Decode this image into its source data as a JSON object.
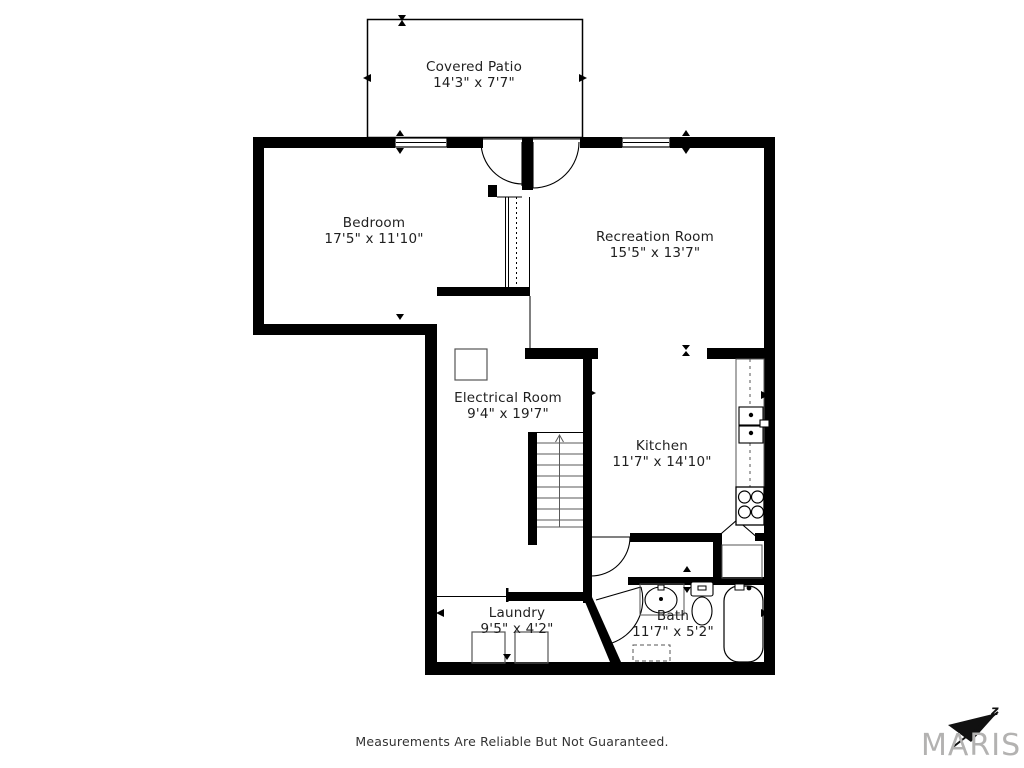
{
  "rooms": [
    {
      "id": "covered-patio",
      "name": "Covered Patio",
      "dims": "14'3\" x 7'7\""
    },
    {
      "id": "bedroom",
      "name": "Bedroom",
      "dims": "17'5\" x 11'10\""
    },
    {
      "id": "recreation-room",
      "name": "Recreation Room",
      "dims": "15'5\" x 13'7\""
    },
    {
      "id": "electrical-room",
      "name": "Electrical Room",
      "dims": "9'4\" x 19'7\""
    },
    {
      "id": "kitchen",
      "name": "Kitchen",
      "dims": "11'7\" x 14'10\""
    },
    {
      "id": "laundry",
      "name": "Laundry",
      "dims": "9'5\" x 4'2\""
    },
    {
      "id": "bath",
      "name": "Bath",
      "dims": "11'7\" x 5'2\""
    }
  ],
  "footer": {
    "disclaimer": "Measurements Are Reliable But Not Guaranteed."
  },
  "logo": {
    "text": "MARIS",
    "mark": "z"
  },
  "colors": {
    "wall": "#000000",
    "line": "#3d3d3d",
    "label": "#1f1f1f",
    "logo_gray": "#b3b2b1"
  },
  "fixtures": [
    "staircase",
    "electrical-panel",
    "kitchen-counter",
    "kitchen-sink",
    "stove",
    "pantry-bifold-door",
    "pantry-shelf",
    "washer",
    "dryer",
    "vanity-sink",
    "toilet",
    "bathtub",
    "bath-floor-vent",
    "window",
    "patio-double-door",
    "interior-door",
    "closet-sliding-door",
    "covered-patio-outline",
    "dimension-marker",
    "maris-logo-triangle"
  ]
}
